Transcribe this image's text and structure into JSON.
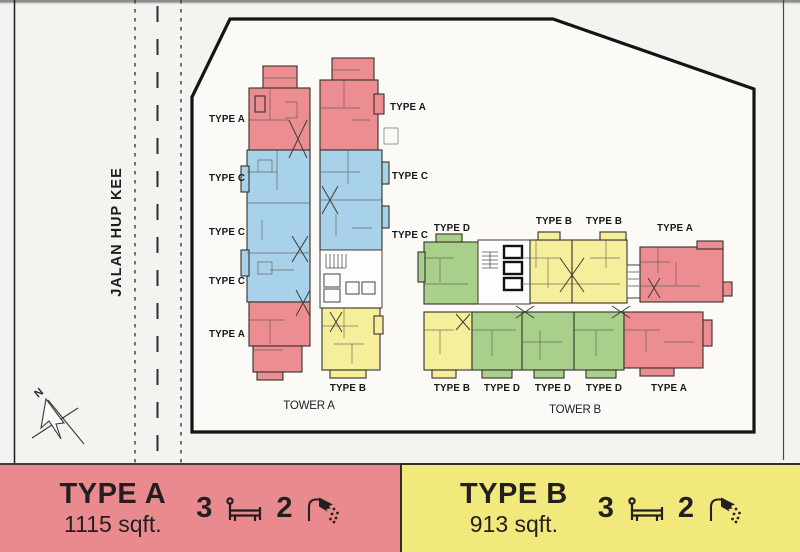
{
  "page": {
    "background": "#f5f3ef"
  },
  "plan": {
    "road_name": "JALAN HUP KEE",
    "compass_north": "N",
    "tower_a": {
      "name": "TOWER A",
      "left_labels": [
        "TYPE A",
        "TYPE C",
        "TYPE C",
        "TYPE C",
        "TYPE A"
      ],
      "right_labels": [
        "TYPE A",
        "TYPE C",
        "TYPE C"
      ],
      "bottom_label": "TYPE B"
    },
    "tower_b": {
      "name": "TOWER B",
      "top_labels": [
        "TYPE D",
        "TYPE B",
        "TYPE B",
        "TYPE A"
      ],
      "bottom_labels": [
        "TYPE B",
        "TYPE D",
        "TYPE D",
        "TYPE D",
        "TYPE A"
      ]
    }
  },
  "colors": {
    "unit_type_a": "#ec8e91",
    "unit_type_b": "#f5ef9b",
    "unit_type_c": "#a8d2e9",
    "unit_type_d": "#a9d08a",
    "legend_type_a_bg": "#e98b8e",
    "legend_type_b_bg": "#f2e97c"
  },
  "legend": {
    "items": [
      {
        "name": "TYPE A",
        "area": "1115 sqft.",
        "bedrooms": "3",
        "bathrooms": "2"
      },
      {
        "name": "TYPE B",
        "area": "913 sqft.",
        "bedrooms": "3",
        "bathrooms": "2"
      }
    ]
  }
}
